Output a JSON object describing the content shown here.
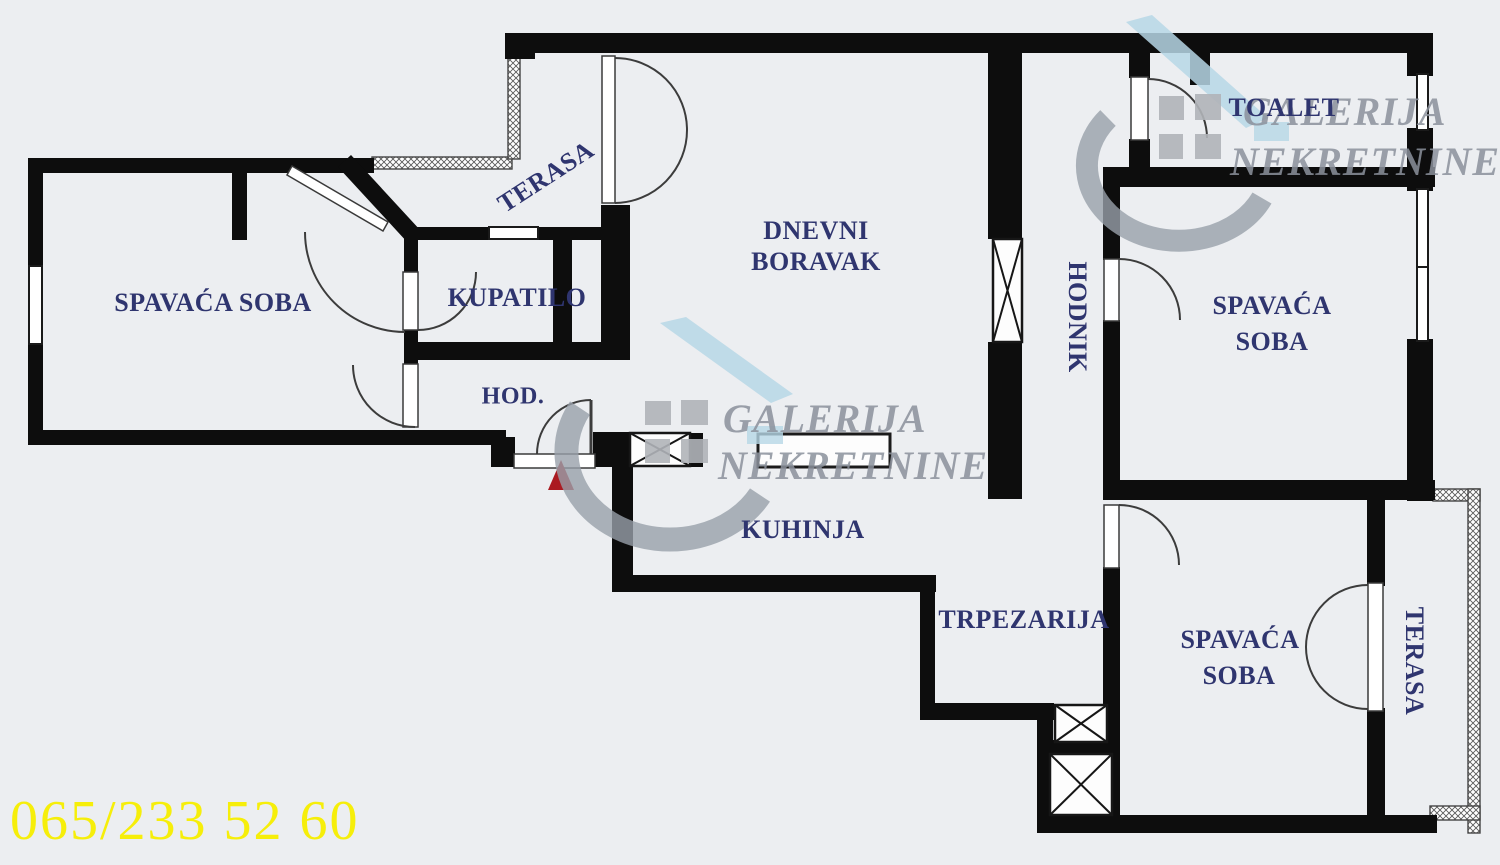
{
  "meta": {
    "title": "Apartment floor plan",
    "width": 1500,
    "height": 865,
    "background": "#eceef1"
  },
  "colors": {
    "wall": "#0d0d0d",
    "room_label": "#2f356f",
    "phone_yellow": "#f6ee0a",
    "entrance_arrow_red": "#ab1a21",
    "watermark_grey": "#99a0aa",
    "watermark_blue": "#b7d7e6",
    "watermark_squares": "#b1b4b9"
  },
  "rooms": {
    "spavaca_left": "SPAVAĆA SOBA",
    "terasa_top": "TERASA",
    "kupatilo": "KUPATILO",
    "hod": "HOD.",
    "dnevni_line1": "DNEVNI",
    "dnevni_line2": "BORAVAK",
    "hodnik": "HODNIK",
    "toalet": "TOALET",
    "spavaca_right_line1": "SPAVAĆA",
    "spavaca_right_line2": "SOBA",
    "kuhinja": "KUHINJA",
    "trpezarija": "TRPEZARIJA",
    "spavaca_bottom_line1": "SPAVAĆA",
    "spavaca_bottom_line2": "SOBA",
    "terasa_right": "TERASA"
  },
  "watermark": {
    "line1": "GALERIJA",
    "line2": "NEKRETNINE"
  },
  "contact": {
    "phone": "065/233 52 60"
  }
}
